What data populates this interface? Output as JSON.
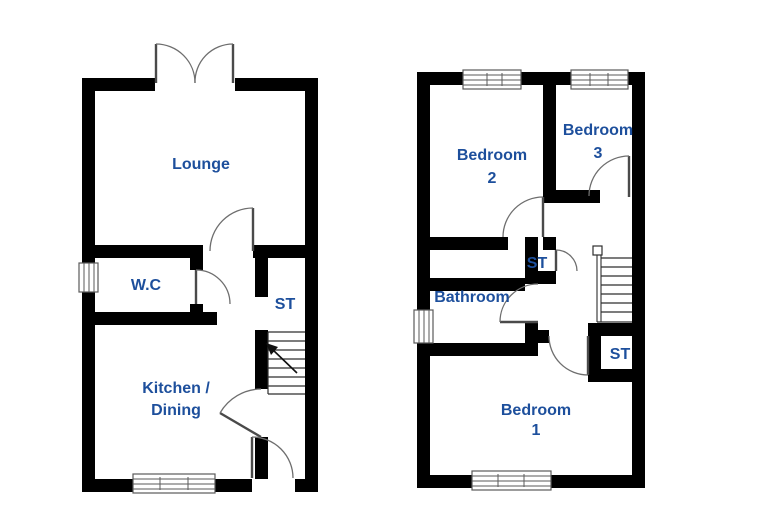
{
  "floorplan": {
    "label_color": "#1d4f9c",
    "wall_color": "#000000",
    "ground_floor": {
      "rooms": [
        {
          "label": "Lounge"
        },
        {
          "label": "W.C"
        },
        {
          "label": "ST"
        },
        {
          "line1": "Kitchen /",
          "line2": "Dining"
        }
      ]
    },
    "first_floor": {
      "rooms": [
        {
          "line1": "Bedroom",
          "line2": "2"
        },
        {
          "line1": "Bedroom",
          "line2": "3"
        },
        {
          "label": "Bathroom"
        },
        {
          "label": "ST"
        },
        {
          "label": "ST"
        },
        {
          "line1": "Bedroom",
          "line2": "1"
        }
      ]
    }
  }
}
